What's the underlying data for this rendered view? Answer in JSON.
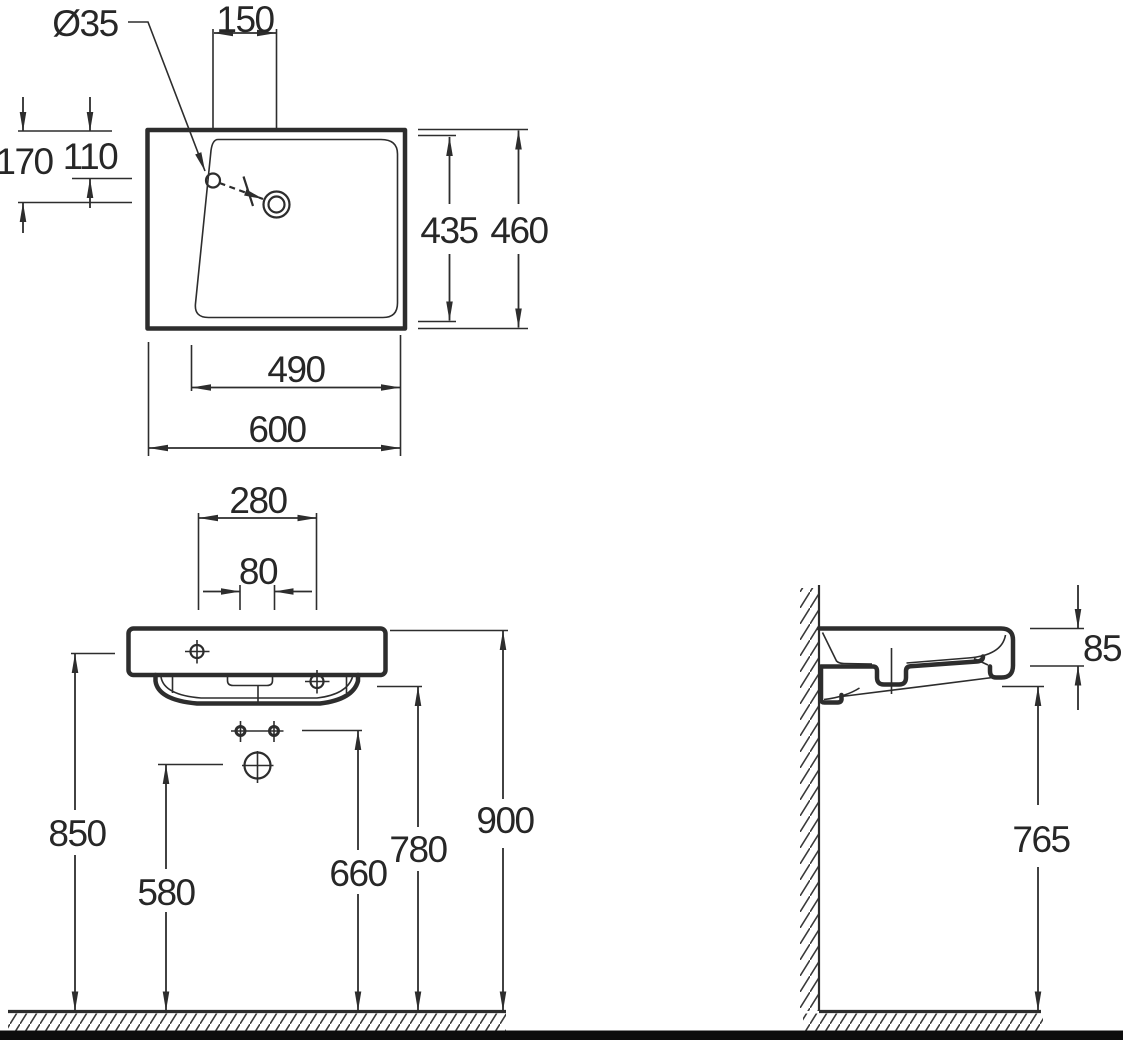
{
  "drawing": {
    "type": "technical-dimension-drawing",
    "subject": "wall-mounted washbasin, three orthographic views",
    "colors": {
      "line": "#2d2d2d",
      "background": "#ffffff",
      "bottom_bar": "#0c0c0c"
    },
    "top_view": {
      "faucet_hole_diameter": "Ø35",
      "faucet_to_drain_offset": "150",
      "top_edge_to_drain": "170",
      "top_edge_to_faucet": "110",
      "inner_depth": "435",
      "overall_depth": "460",
      "inner_width": "490",
      "overall_width": "600"
    },
    "front_view": {
      "fixing_span": "280",
      "bolt_spacing": "80",
      "rim_side_height": "850",
      "trap_outlet_height": "580",
      "bolt_height": "660",
      "underside_height": "780",
      "top_height": "900"
    },
    "side_view": {
      "rim_thickness": "85",
      "clearance_height": "765"
    }
  }
}
